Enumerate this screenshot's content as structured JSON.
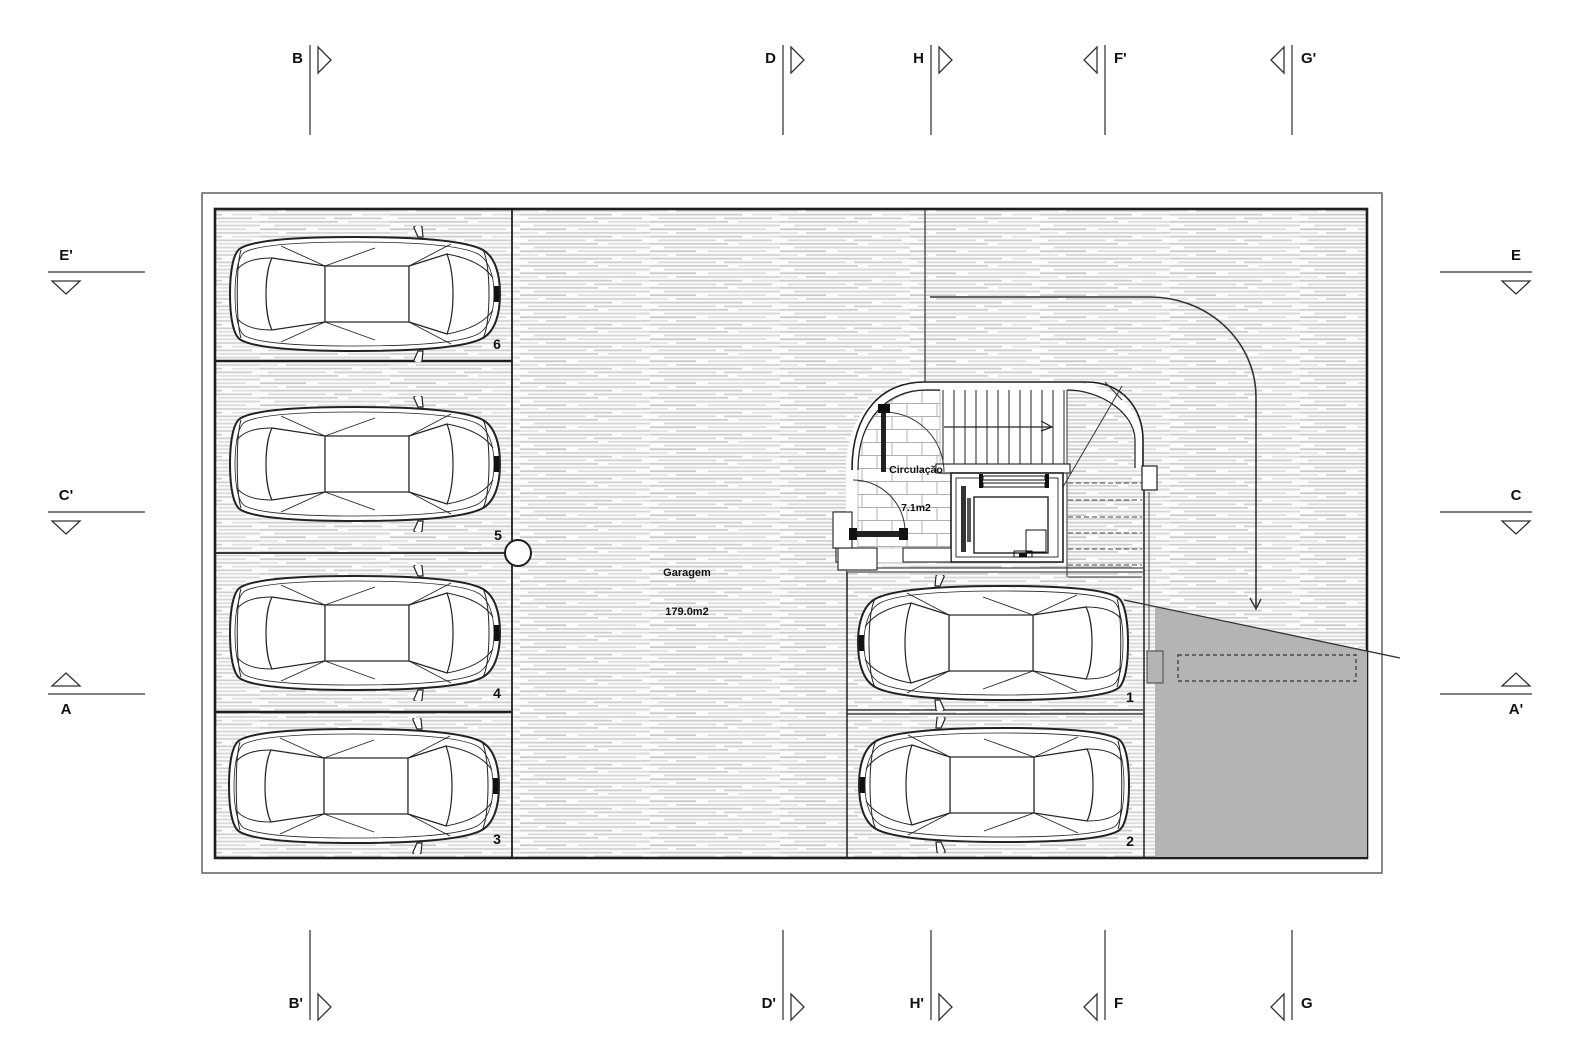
{
  "drawing": {
    "type": "garage floor plan",
    "colors": {
      "ramp_gray": "#b4b4b4",
      "wall_line": "#1f1f1f",
      "hatch_mid": "#cfcfcf",
      "tile_line": "#b0b0b0"
    }
  },
  "rooms": {
    "garage": {
      "name": "Garagem",
      "area": "179.0m2"
    },
    "circulation": {
      "name": "Circulação",
      "area": "7.1m2"
    }
  },
  "parking": {
    "p1": "1",
    "p2": "2",
    "p3": "3",
    "p4": "4",
    "p5": "5",
    "p6": "6"
  },
  "markers": {
    "top_b": "B",
    "top_d": "D",
    "top_h": "H",
    "top_f2": "F'",
    "top_g2": "G'",
    "bottom_b2": "B'",
    "bottom_d2": "D'",
    "bottom_h2": "H'",
    "bottom_f": "F",
    "bottom_g": "G",
    "left_e2": "E'",
    "left_c2": "C'",
    "left_a": "A",
    "right_e": "E",
    "right_c": "C",
    "right_a2": "A'"
  }
}
